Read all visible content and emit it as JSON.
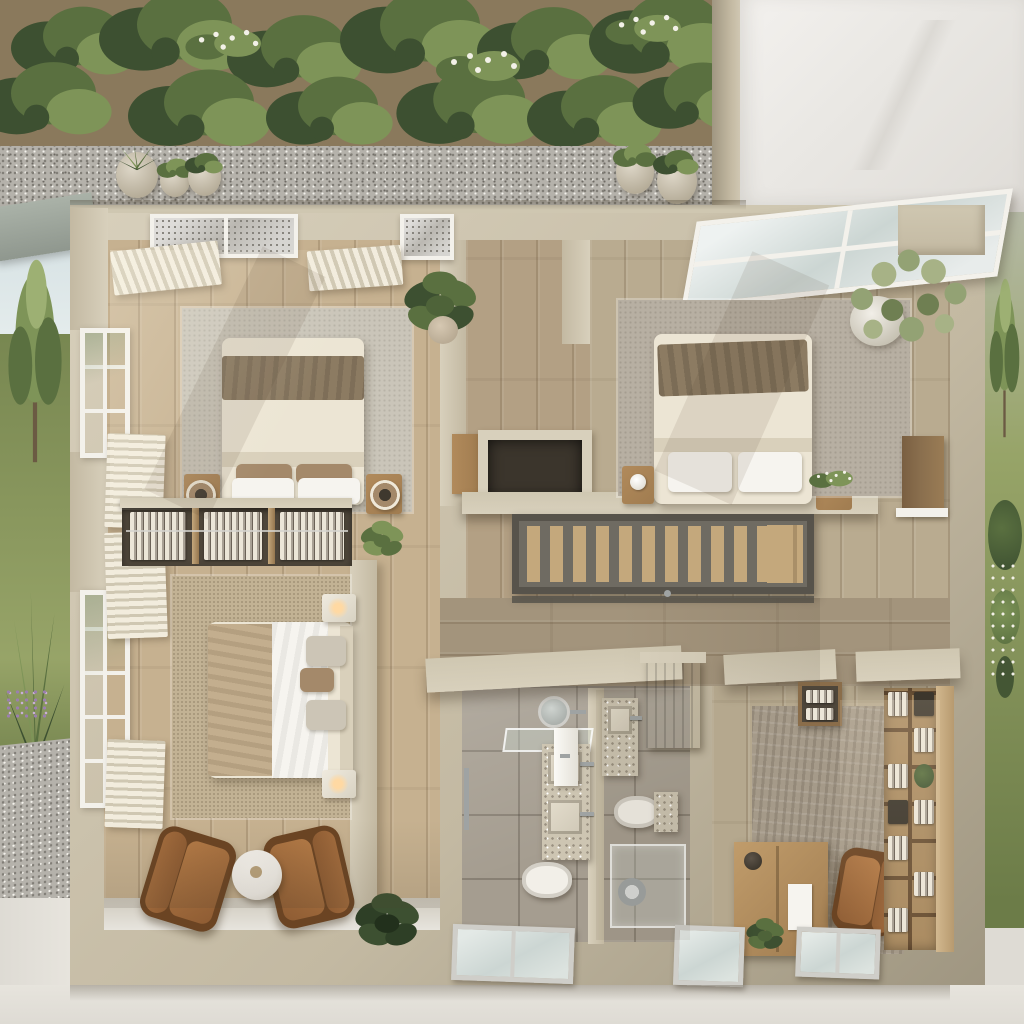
{
  "scene": {
    "type": "3d-floorplan-cutaway-render",
    "view": "top-down",
    "description": "Photorealistic top-down cutaway floor plan of a small house with surrounding garden, gravel path and concrete patio"
  },
  "rooms": {
    "garden": {
      "label": "garden-with-gravel-path"
    },
    "bedroom1": {
      "label": "bedroom-top-left",
      "items": [
        "double-bed",
        "area-rug",
        "nightstand-left",
        "nightstand-right",
        "speaker-lamp-left",
        "speaker-lamp-right",
        "fiddle-leaf-plant",
        "skylights",
        "pleated-curtains",
        "side-windows"
      ]
    },
    "bedroom2": {
      "label": "bedroom-middle-left",
      "items": [
        "double-bed",
        "textured-rug",
        "nightstand-top",
        "nightstand-bottom",
        "table-lamps",
        "window-curtains"
      ]
    },
    "closet": {
      "label": "open-shelf-closet-divider",
      "bays": 3,
      "items": [
        "folded-linens",
        "hanging-rail",
        "small-plant"
      ]
    },
    "sitting": {
      "label": "sitting-area",
      "items": [
        "leather-armchair-left",
        "leather-armchair-right",
        "round-marble-side-table",
        "potted-plant"
      ]
    },
    "stairzone": {
      "label": "staircase-landing",
      "items": [
        "stair-void",
        "display-ledge",
        "canisters",
        "flower-planter",
        "wood-cabinet"
      ]
    },
    "stairs": {
      "label": "staircase",
      "tread_count": 13
    },
    "bedroom3": {
      "label": "bedroom-right",
      "items": [
        "double-bed",
        "grey-rug",
        "wood-nightstand",
        "olive-tree-pot",
        "flower-plant",
        "slanted-skylight",
        "wall-nook-panel"
      ]
    },
    "hallway": {
      "label": "hallway-wood-floor"
    },
    "bathroom": {
      "label": "bathroom",
      "items": [
        "round-mirror",
        "glass-shelf",
        "double-sink-vanity",
        "second-vanity",
        "toilet-left",
        "toilet-right",
        "glass-shower",
        "towel-bar",
        "white-door",
        "wood-pocket-door"
      ]
    },
    "office": {
      "label": "study-dressing-room",
      "items": [
        "area-rug",
        "wood-desk",
        "desk-lamp",
        "paper-sheet",
        "desk-plant",
        "leather-desk-chair",
        "linen-shelving-unit",
        "entry-cubby"
      ]
    },
    "exterior": {
      "label": "lawn-gravel-concrete-surround",
      "bottom_window_count": 3,
      "planter_pots_left": 3,
      "planter_pots_center": 2
    }
  },
  "palette": {
    "wall": "#c3b9a2",
    "wall_light": "#d8d0bc",
    "wall_dark": "#9f9681",
    "wall_top": "#cfc7b1",
    "wall_white": "#edebe7",
    "wood_a": "#c6b190",
    "wood_b": "#b3a084",
    "wood_b2": "#b9ab90",
    "wood_c": "#a3947c",
    "plank_line": "rgba(80,58,35,0.18)",
    "stone": "#a59d90",
    "stone_light": "#b4ac9f",
    "grout": "rgba(70,62,52,0.30)",
    "gravel": "#b5b2ab",
    "gravel_dot": "#827f78",
    "concrete": "#dedbd4",
    "concrete_light": "#e7e4dd",
    "grass_light": "#97a468",
    "grass_dark": "#6c7c48",
    "green_dark": "#3d5031",
    "green_mid": "#5a7040",
    "green_light": "#7e9458",
    "olive": "#93a274",
    "dirt": "#8a795c",
    "bed_cream": "#ece5d4",
    "bed_cream_dark": "#d9d0bb",
    "blanket": "#8c7b62",
    "pillow_tan": "#a4896a",
    "pillow_grey": "#ccc5b6",
    "leather": "#8e5c33",
    "leather_dark": "#6b4423",
    "rug_a": "#cac5b9",
    "rug_b": "#c2b294",
    "rug_c": "#b7afa2",
    "rug_office": "#a59a89",
    "stair_base": "#6f6b62",
    "stair_wood": "#c4a87c",
    "stair_rail": "#57534b",
    "frame_white": "#f3f1eb",
    "frame_silver": "#cfcec9",
    "glass": "#ccd6d3",
    "glass_sky": "#d9e3e4",
    "curtain": "#f2ecdd",
    "curtain_shadow": "#cfc7b2",
    "terrazzo": "#cdc5b2",
    "terrazzo_dot": "#9a9181",
    "chrome": "#9fa3a3",
    "white": "#f6f4ef",
    "void_dark": "#3b352c",
    "shelf_dark": "#4e463a",
    "wood_furn": "#a07c50",
    "wood_door": "#8a6f4e",
    "wood_shelf": "#ab8c62",
    "lamp_glow": "#ffd9a3",
    "marble": "#f0ede7",
    "sky": "#d3dfe2",
    "purple_flower": "#9b7fae",
    "trunk": "#6b5a43"
  }
}
